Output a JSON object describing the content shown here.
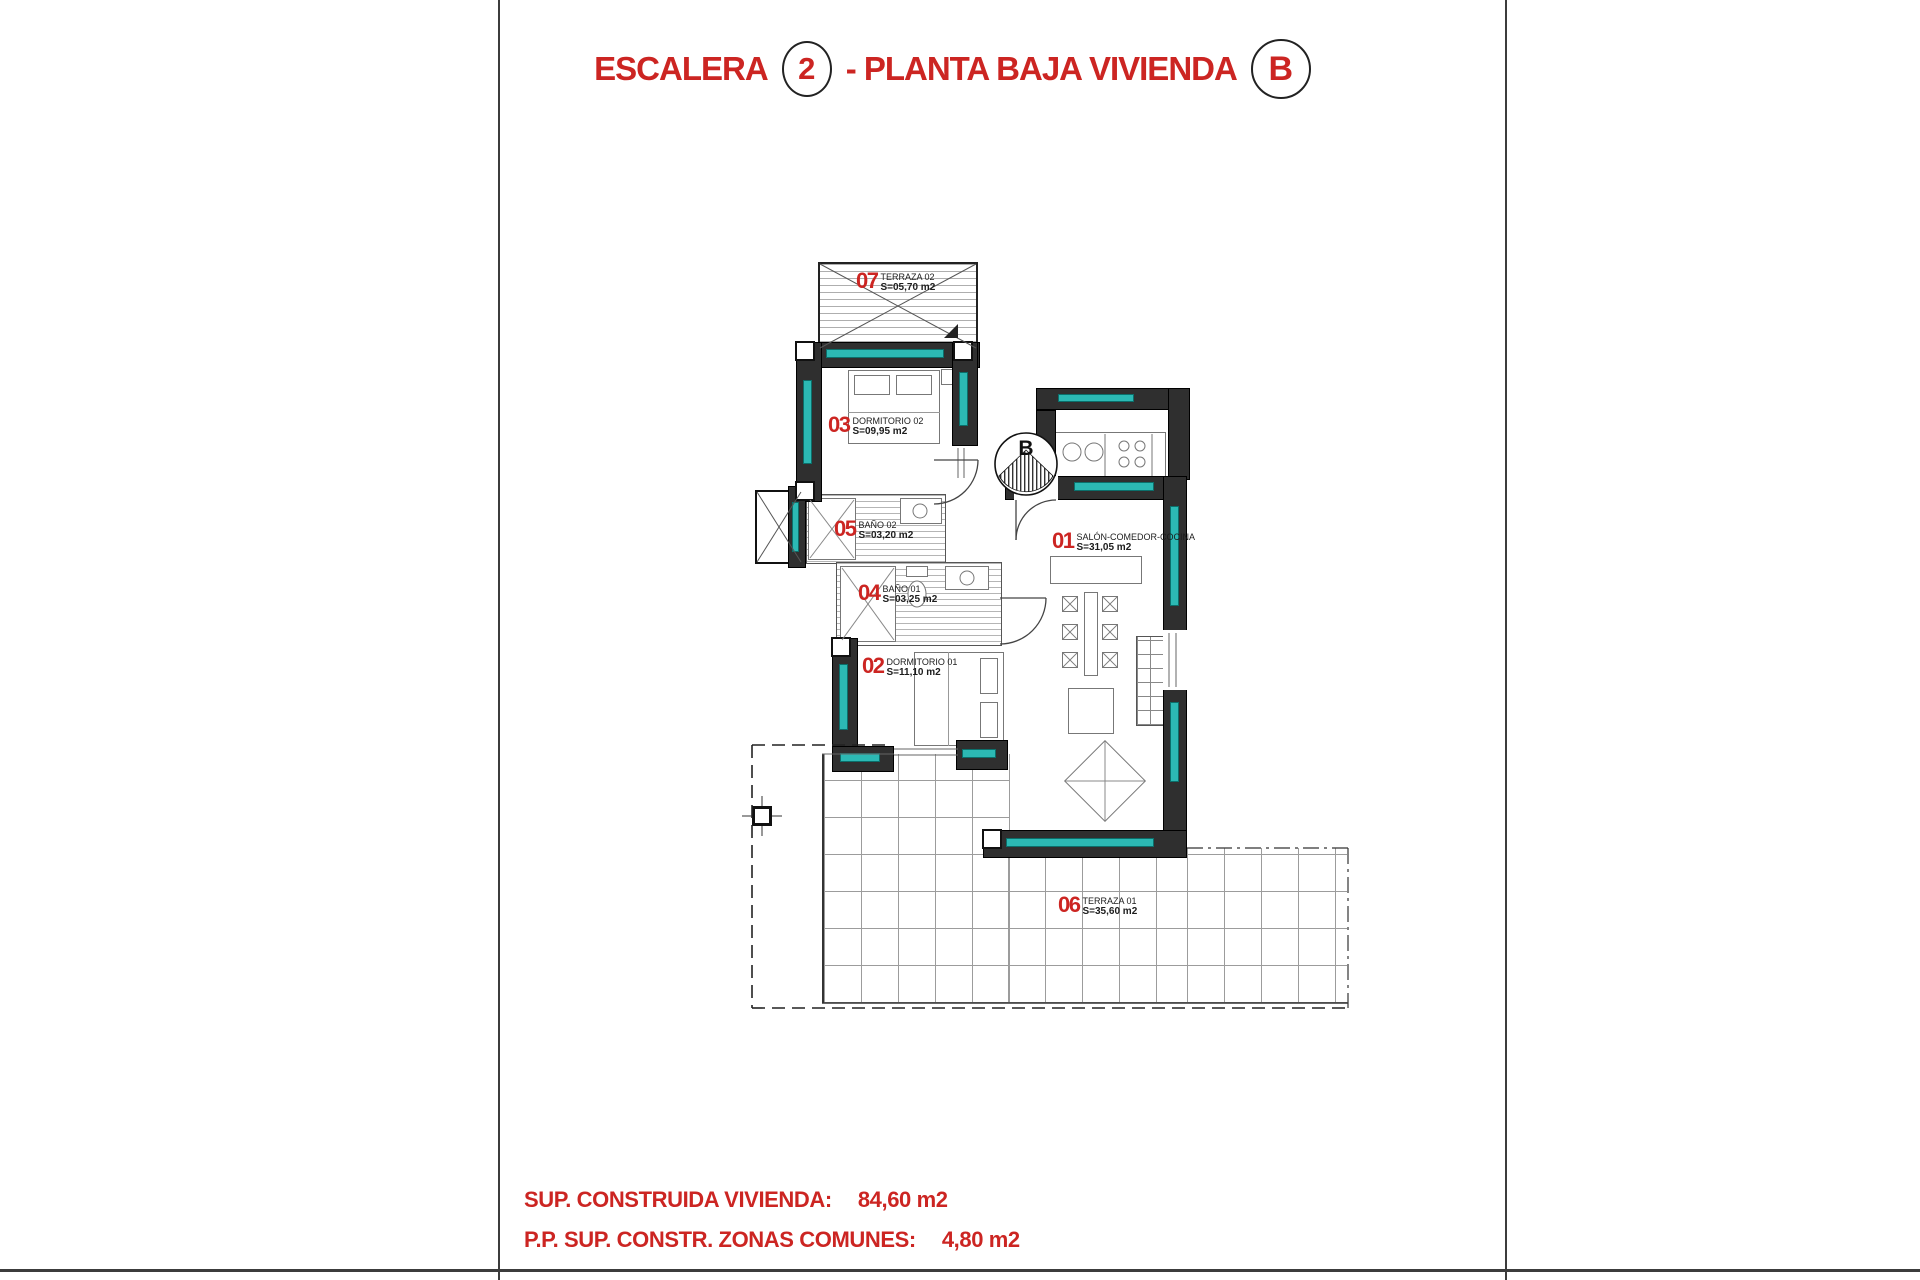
{
  "title": {
    "prefix": "ESCALERA",
    "stair_number": "2",
    "middle": "- PLANTA BAJA VIVIENDA",
    "unit_letter": "B"
  },
  "rooms": [
    {
      "num": "07",
      "name": "TERRAZA 02",
      "area": "S=05,70 m2"
    },
    {
      "num": "03",
      "name": "DORMITORIO 02",
      "area": "S=09,95 m2"
    },
    {
      "num": "05",
      "name": "BAÑO 02",
      "area": "S=03,20 m2"
    },
    {
      "num": "04",
      "name": "BAÑO 01",
      "area": "S=03,25 m2"
    },
    {
      "num": "02",
      "name": "DORMITORIO 01",
      "area": "S=11,10 m2"
    },
    {
      "num": "01",
      "name": "SALÓN-COMEDOR-COCINA",
      "area": "S=31,05 m2"
    },
    {
      "num": "06",
      "name": "TERRAZA 01",
      "area": "S=35,60 m2"
    }
  ],
  "entrance_marker": {
    "letter": "B"
  },
  "summary": {
    "line1_label": "SUP. CONSTRUIDA VIVIENDA:",
    "line1_value": "84,60 m2",
    "line2_label": "P.P. SUP. CONSTR. ZONAS COMUNES:",
    "line2_value": "4,80 m2"
  },
  "colors": {
    "red": "#cc2522",
    "teal": "#2cb9b4",
    "wall": "#2f2f2f"
  }
}
